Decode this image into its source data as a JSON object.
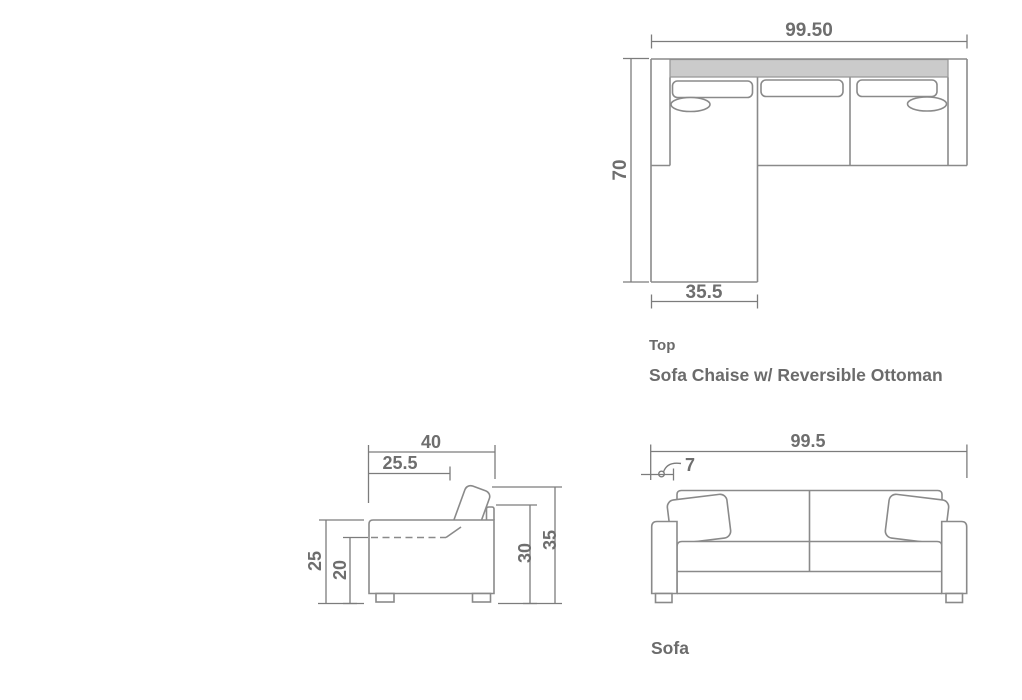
{
  "colors": {
    "outline": "#8a8a8a",
    "dimension": "#7c7c7c",
    "text": "#6e6e6e",
    "back_cushion_fill": "#cbcbcb",
    "background": "#ffffff"
  },
  "top_view": {
    "caption": "Top",
    "title": "Sofa Chaise w/ Reversible Ottoman",
    "dim_overall_width": "99.50",
    "dim_overall_depth": "70",
    "dim_chaise_width": "35.5"
  },
  "side_view": {
    "dim_overall_depth": "40",
    "dim_seat_depth": "25.5",
    "dim_arm_height": "25",
    "dim_seat_height": "20",
    "dim_back_height": "30",
    "dim_overall_height": "35"
  },
  "front_view": {
    "caption": "Sofa",
    "dim_overall_width": "99.5",
    "dim_arm_width": "7"
  }
}
